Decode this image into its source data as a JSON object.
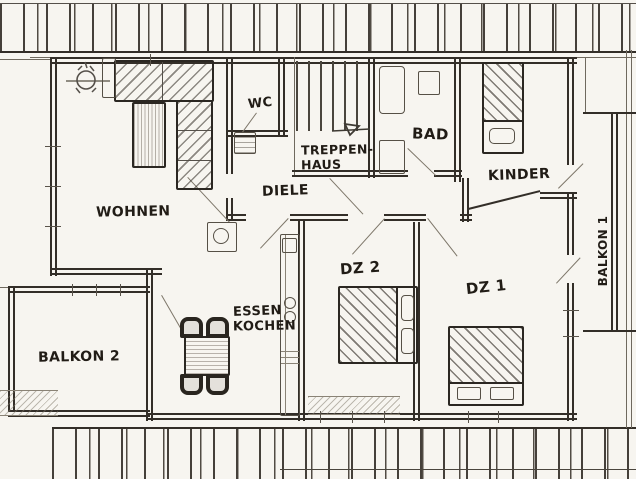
{
  "colors": {
    "paper": "#f7f5f0",
    "ink": "#332e28",
    "pencil": "#6f695e",
    "label_text": "#211c16"
  },
  "rooms": {
    "wohnen": {
      "label": "WOHNEN"
    },
    "wc": {
      "label": "WC"
    },
    "treppenhaus": {
      "label_line1": "TREPPEN-",
      "label_line2": "HAUS"
    },
    "diele": {
      "label": "DIELE"
    },
    "bad": {
      "label": "BAD"
    },
    "kinder": {
      "label": "KINDER"
    },
    "essen_kochen": {
      "label_line1": "ESSEN",
      "label_line2": "KOCHEN"
    },
    "balkon1": {
      "label": "BALKON 1"
    },
    "balkon2": {
      "label": "BALKON 2"
    },
    "dz1": {
      "label": "DZ 1"
    },
    "dz2": {
      "label": "DZ 2"
    }
  }
}
